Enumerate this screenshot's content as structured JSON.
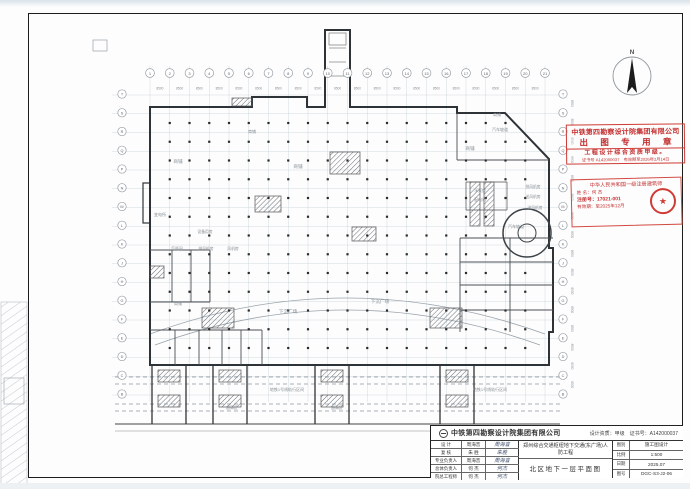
{
  "colors": {
    "stamp_red": "#cf3b35",
    "wall_dark": "#2e3338",
    "grid_light": "#ccd6dd",
    "label_gray": "#868e95"
  },
  "sheet": {
    "north_label": "N",
    "dim_label": "8500",
    "axis_top_numbers": [
      "1",
      "2",
      "3",
      "4",
      "5",
      "6",
      "7",
      "8",
      "9",
      "10",
      "11",
      "12",
      "13",
      "14",
      "15",
      "16",
      "17",
      "18",
      "19",
      "20",
      "21"
    ],
    "axis_side_letters": [
      "T",
      "S",
      "R",
      "Q",
      "P",
      "N",
      "M",
      "L",
      "K",
      "J",
      "H",
      "G",
      "F",
      "E",
      "D",
      "C",
      "B"
    ],
    "rooms": [
      {
        "t": "商铺",
        "x": 178,
        "y": 163,
        "s": 4.6
      },
      {
        "t": "商铺",
        "x": 298,
        "y": 168,
        "s": 4.6
      },
      {
        "t": "商铺",
        "x": 470,
        "y": 150,
        "s": 4.6
      },
      {
        "t": "商铺",
        "x": 497,
        "y": 116,
        "s": 4
      },
      {
        "t": "商铺",
        "x": 252,
        "y": 133,
        "s": 4
      },
      {
        "t": "商铺",
        "x": 178,
        "y": 305,
        "s": 4
      },
      {
        "t": "下沉广场",
        "x": 288,
        "y": 313,
        "s": 4.6
      },
      {
        "t": "下沉广场",
        "x": 380,
        "y": 303,
        "s": 4.6
      },
      {
        "t": "汽车坡道",
        "x": 500,
        "y": 131,
        "s": 4
      },
      {
        "t": "汽车坡道",
        "x": 516,
        "y": 228,
        "s": 4
      },
      {
        "t": "变电所",
        "x": 160,
        "y": 216,
        "s": 4
      },
      {
        "t": "气瓶间",
        "x": 177,
        "y": 250,
        "s": 3.8
      },
      {
        "t": "排风机房",
        "x": 206,
        "y": 250,
        "s": 3.8
      },
      {
        "t": "风机房",
        "x": 233,
        "y": 250,
        "s": 3.8
      },
      {
        "t": "设备用房",
        "x": 205,
        "y": 233,
        "s": 3.8
      },
      {
        "t": "水泵房",
        "x": 480,
        "y": 192,
        "s": 3.8
      },
      {
        "t": "配电间",
        "x": 480,
        "y": 201,
        "s": 3.8
      },
      {
        "t": "排风机房",
        "x": 533,
        "y": 188,
        "s": 3.8
      },
      {
        "t": "送风机房",
        "x": 533,
        "y": 198,
        "s": 3.8
      },
      {
        "t": "进风机房",
        "x": 535,
        "y": 209,
        "s": 3.8
      },
      {
        "t": "超高区",
        "x": 232,
        "y": 409,
        "s": 3.8
      },
      {
        "t": "超高区",
        "x": 337,
        "y": 409,
        "s": 3.8
      },
      {
        "t": "地铁1号线轨行区间",
        "x": 287,
        "y": 391,
        "s": 4
      },
      {
        "t": "地铁1号线轨行区间",
        "x": 490,
        "y": 391,
        "s": 4
      }
    ]
  },
  "stamp_institute": {
    "company": "中铁第四勘察设计院集团有限公司",
    "title": "出 图 专 用 章",
    "qualification": "工程设计综合资质甲级。",
    "cert_line": "证书号 A142000037　有效期至2026年2月14日"
  },
  "stamp_architect": {
    "header": "中华人民共和国一级注册建筑师",
    "name_row": "姓 名：何 杰",
    "reg_row": "注册号：17021-001",
    "valid_row": "有效期：至2025年12月",
    "seal_star": "★"
  },
  "title_block": {
    "company": "中铁第四勘察设计院集团有限公司",
    "qualification": "设计资质：甲级　证书号：A142000037",
    "rows": [
      {
        "role": "设 计",
        "name": "周海音",
        "sig": "周海音"
      },
      {
        "role": "复 核",
        "name": "朱 胜",
        "sig": "朱胜"
      },
      {
        "role": "专业负责人",
        "name": "周海音",
        "sig": "周海音"
      },
      {
        "role": "总体负责人",
        "name": "何 杰",
        "sig": "何杰"
      },
      {
        "role": "院总工程师",
        "name": "何 杰",
        "sig": "何杰"
      }
    ],
    "project": "郑州综合交通枢纽地下交通(东广场)人防工程",
    "drawing_title": "北区地下一层平面图",
    "info": [
      {
        "label": "图别",
        "value": "施工图设计"
      },
      {
        "label": "比例",
        "value": "1:500"
      },
      {
        "label": "日期",
        "value": "2025.07"
      },
      {
        "label": "图号",
        "value": "DGC-S3-J2-06"
      }
    ]
  }
}
